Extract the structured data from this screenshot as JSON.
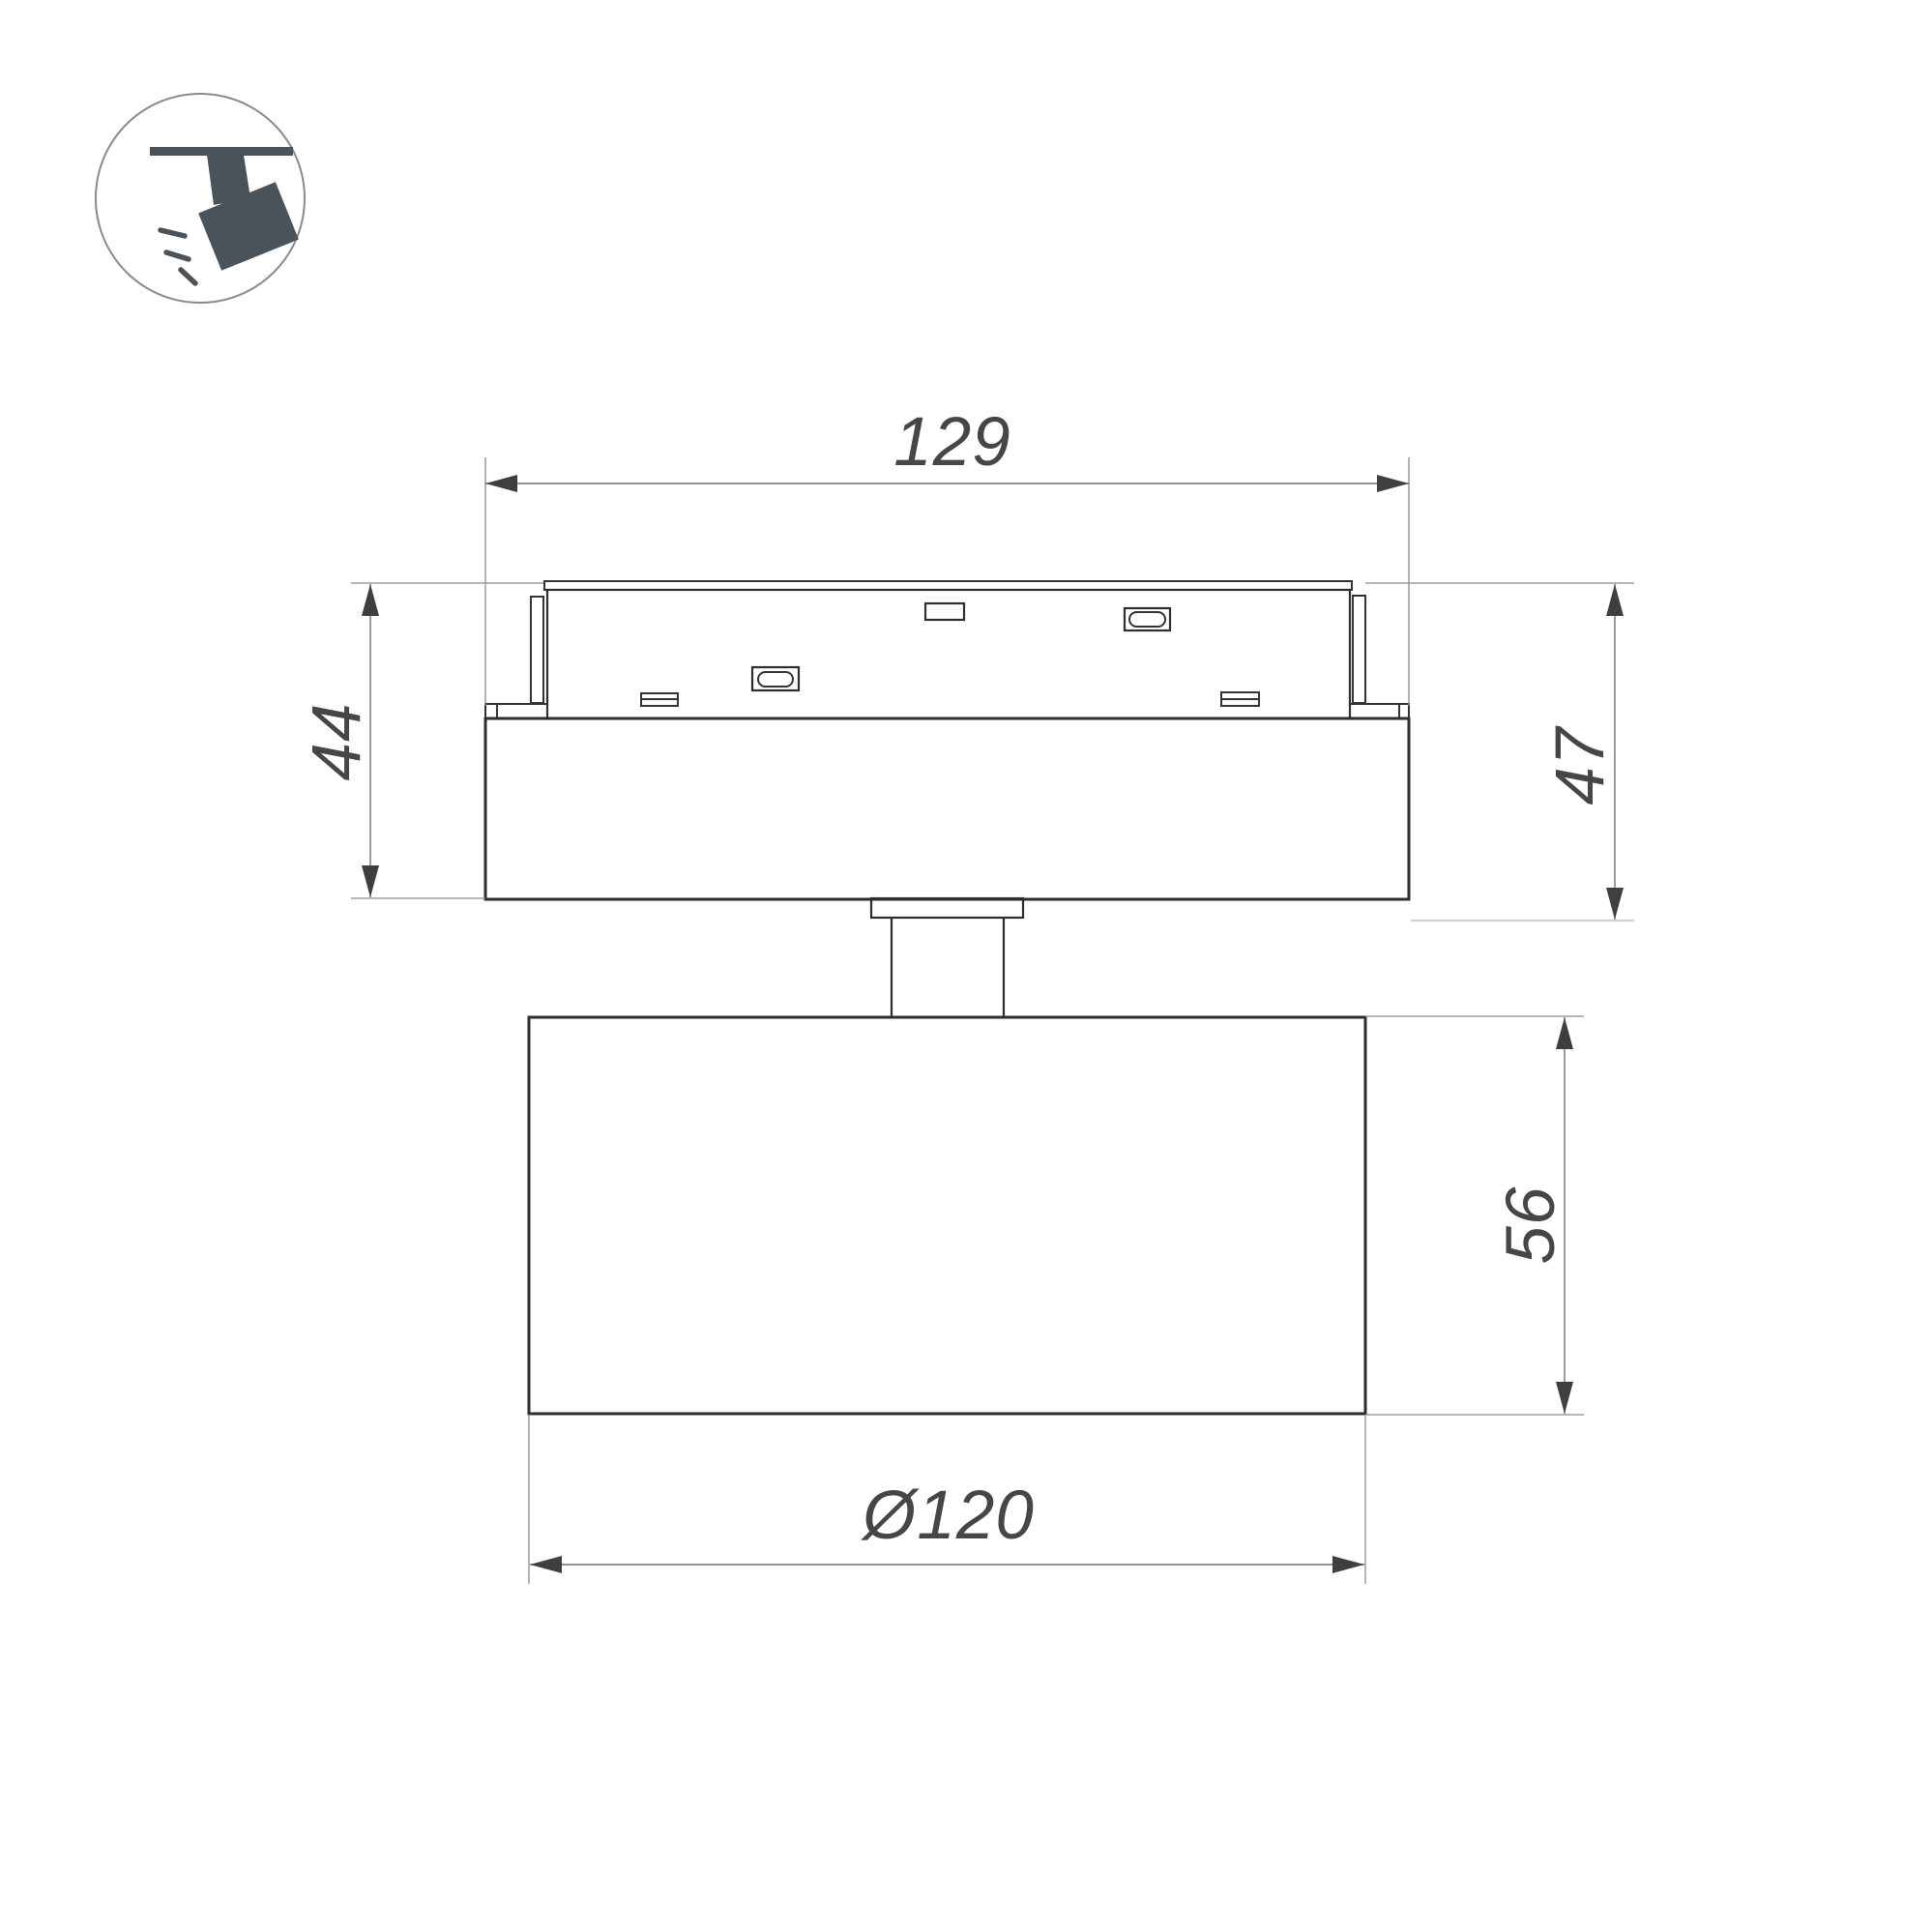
{
  "drawing": {
    "description": "Technical dimension drawing of a track-mounted spotlight, side view",
    "views": {
      "adapter": "track adapter module with contact slots and latch buttons",
      "housing": "driver housing box",
      "head": "cylindrical lamp head on pivot stem"
    }
  },
  "icon": {
    "name": "track-spotlight-icon",
    "meaning": "spotlight hanging from ceiling track"
  },
  "dimensions": {
    "track_width": "129",
    "base_height_left": "44",
    "base_height_right": "47",
    "head_height": "56",
    "head_diameter": "Ø120"
  },
  "colors": {
    "background": "#ffffff",
    "outline": "#2d2d2d",
    "dimension_line": "#6f6f6f",
    "extension_line": "#8b8b8b",
    "extension_line_light": "#b5b5b5",
    "dimension_text": "#464646",
    "arrow": "#3f3f3f",
    "icon_glyph": "#4a525a",
    "icon_circle_stroke": "#8a8a8a"
  }
}
